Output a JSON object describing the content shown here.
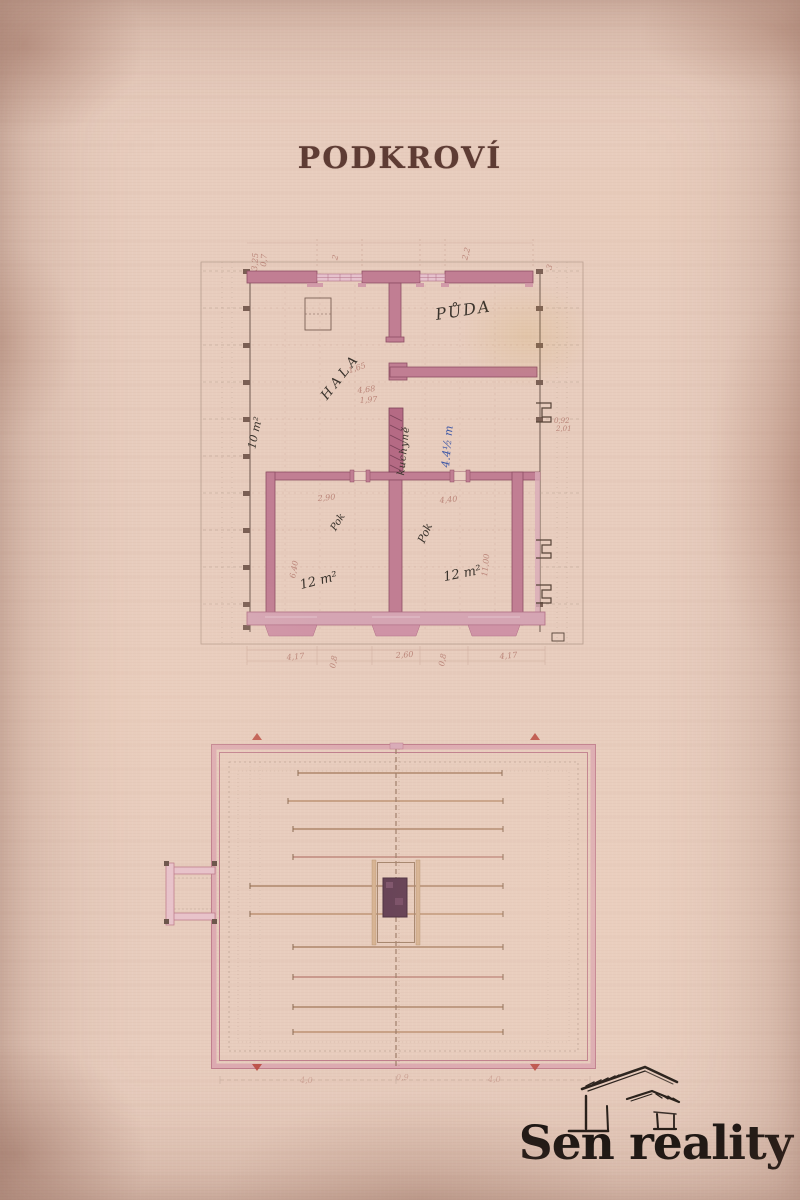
{
  "page": {
    "title": "PODKROVÍ"
  },
  "logo": {
    "brand": "Sen reality",
    "icon": "sketched-roof-icon"
  },
  "colors": {
    "paper": "#e8cdbe",
    "wall_fill": "#c17e93",
    "wall_fill_light": "#d5a5b3",
    "ink": "#3a332c",
    "blue_ink": "#3d57a6",
    "dim_red": "#a96a5f",
    "logo_black": "#191512",
    "chimney_dark": "#5f3a50"
  },
  "upper_plan": {
    "name": "attic floor plan",
    "labels": {
      "puda": "PŮDA",
      "hala": "HALA",
      "small_room": "10 m²",
      "pok_left": "Pok",
      "pok_right": "Pok",
      "area_left": "12 m²",
      "area_right": "12 m²",
      "note_black": "kuchyně",
      "note_blue": "4.4½ m"
    },
    "dims": [
      "3,25",
      "0,7",
      "2",
      "2,2",
      "3",
      "1,65",
      "4,68",
      "1,97",
      "2,90",
      "4,40",
      "6,40",
      "11,00",
      "0,92",
      "2,01",
      "0,8",
      "0,8",
      "4,17",
      "2,60",
      "4,17"
    ]
  },
  "lower_plan": {
    "name": "roof framing plan",
    "dims": [
      "4,0",
      "0,9",
      "4,0"
    ]
  }
}
